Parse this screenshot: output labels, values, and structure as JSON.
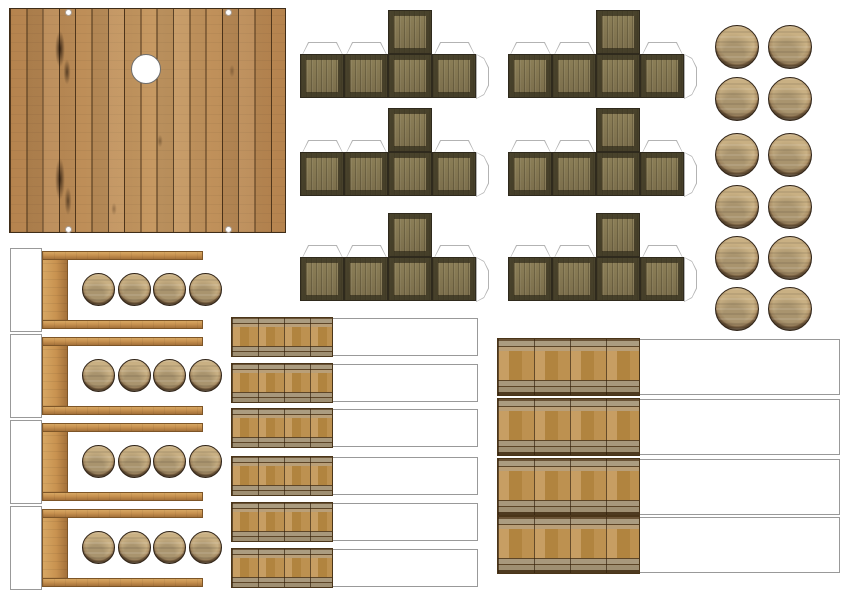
{
  "sheet": {
    "title": "wooden-dock-papercraft-sheet",
    "width": 849,
    "height": 600,
    "background": "#ffffff"
  },
  "colors": {
    "background": "#ffffff",
    "deck_wood": "#b5834e",
    "deck_wood_light": "#c79a63",
    "deck_seam": "#50361b",
    "deck_border": "#3f2d18",
    "crate_panel": "#8d8058",
    "crate_panel_dark": "#7a6d4b",
    "crate_edge": "#2f2a1d",
    "tab_outline": "#b3b3b3",
    "barrel_face": "#c9b083",
    "barrel_rim": "#53402a",
    "shelf_wood": "#c89250",
    "shelf_wood_light": "#d7a763",
    "shelf_wood_dark": "#a4713a",
    "shelf_border": "#7d5527",
    "strip_wood": "#bd9150",
    "strip_wood_dark": "#b1843f",
    "strip_band": "#ab9c80",
    "strip_seam": "#5d4527",
    "box_border": "#999999"
  },
  "deck": {
    "plank_count": 17,
    "porthole_count": 1,
    "corner_hole_count": 4
  },
  "crates": {
    "count": 6,
    "columns": 2,
    "rows": 3,
    "faces_per_net": 5,
    "glue_tabs_per_net": 4
  },
  "barrel_tops": {
    "count": 12,
    "columns": 2,
    "rows": 6
  },
  "shelf_units": {
    "count": 4,
    "barrels_per_unit": 4
  },
  "barrel_strips_small": {
    "count": 6
  },
  "barrel_strips_large": {
    "count": 4
  }
}
